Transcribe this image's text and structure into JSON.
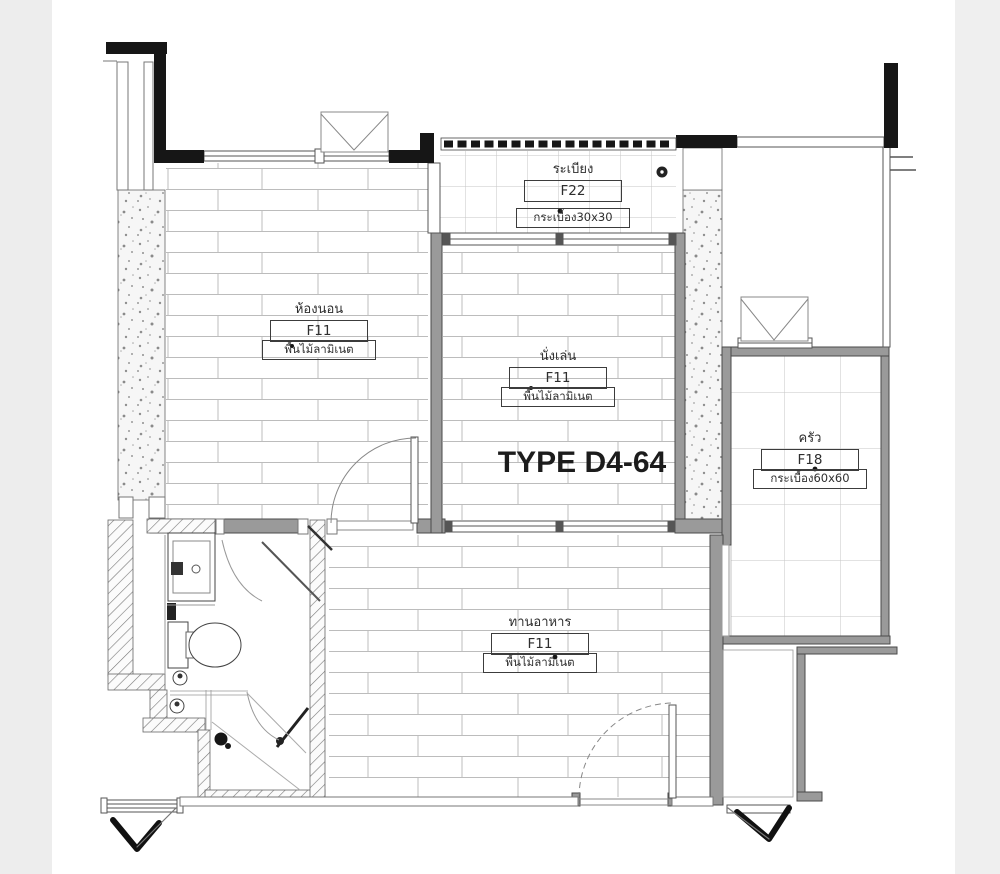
{
  "title": {
    "text": "TYPE D4-64"
  },
  "rooms": {
    "balcony": {
      "name": "ระเบียง",
      "code": "F22",
      "material": "กระเบื้อง30x30"
    },
    "bedroom": {
      "name": "ห้องนอน",
      "code": "F11",
      "material": "พื้นไม้ลามิเนต"
    },
    "living": {
      "name": "นั่งเล่น",
      "code": "F11",
      "material": "พื้นไม้ลามิเนต"
    },
    "kitchen": {
      "name": "ครัว",
      "code": "F18",
      "material": "กระเบื้อง60x60"
    },
    "dining": {
      "name": "ทานอาหาร",
      "code": "F11",
      "material": "พื้นไม้ลามิเนต"
    }
  },
  "colors": {
    "wall_black": "#161616",
    "wall_gray": "#9a9a9a",
    "line_dark": "#4a4a4a",
    "floor_line": "#bcbcbc",
    "label_border": "#3c3c3c",
    "page_bg": "#ffffff",
    "edge_band": "#ededed"
  }
}
